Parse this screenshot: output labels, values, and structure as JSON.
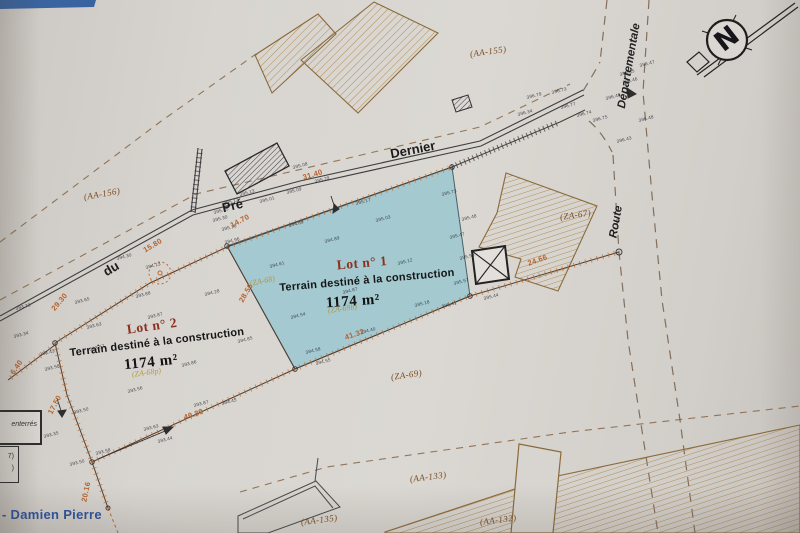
{
  "plan": {
    "compass_label": "N",
    "street": {
      "word1": "du",
      "word2": "Pré",
      "word3": "Dernier"
    },
    "route": {
      "word1": "Route",
      "word2": "Départementale"
    },
    "lot1": {
      "title": "Lot n° 1",
      "subtitle": "Terrain destiné à la construction",
      "area": "1174 m²"
    },
    "lot2": {
      "title": "Lot n° 2",
      "subtitle": "Terrain destiné à la construction",
      "area": "1174 m²"
    },
    "credit": "- Damien Pierre",
    "legend": {
      "box1": "enterrés",
      "box2_line1": "7)",
      "box2_line2": ")"
    },
    "parcel_refs": [
      {
        "v": "(AA-155)",
        "x": 470,
        "y": 50,
        "r": -8
      },
      {
        "v": "(AA-156)",
        "x": 84,
        "y": 193,
        "r": -10
      },
      {
        "v": "(ZA-67)",
        "x": 560,
        "y": 213,
        "r": -8
      },
      {
        "v": "(ZA-69)",
        "x": 391,
        "y": 373,
        "r": -8
      },
      {
        "v": "(AA-133)",
        "x": 410,
        "y": 475,
        "r": -7
      },
      {
        "v": "(AA-135)",
        "x": 301,
        "y": 518,
        "r": -7
      },
      {
        "v": "(AA-132)",
        "x": 480,
        "y": 518,
        "r": -7
      }
    ],
    "old_parcels": [
      {
        "v": "(ZA-68)",
        "x": 250,
        "y": 280,
        "r": -12
      },
      {
        "v": "(ZA-69b)",
        "x": 328,
        "y": 307,
        "r": -8
      },
      {
        "v": "(ZA-68p)",
        "x": 132,
        "y": 371,
        "r": -8
      }
    ],
    "dimensions": [
      {
        "v": "31.40",
        "x": 303,
        "y": 174,
        "r": -17
      },
      {
        "v": "15.80",
        "x": 144,
        "y": 247,
        "r": -31
      },
      {
        "v": "29.30",
        "x": 53,
        "y": 306,
        "r": -50
      },
      {
        "v": "14.70",
        "x": 231,
        "y": 222,
        "r": -28
      },
      {
        "v": "28.56",
        "x": 241,
        "y": 298,
        "r": -60
      },
      {
        "v": "41.32",
        "x": 345,
        "y": 334,
        "r": -19
      },
      {
        "v": "40.39",
        "x": 184,
        "y": 414,
        "r": -19
      },
      {
        "v": "24.66",
        "x": 528,
        "y": 260,
        "r": -20
      },
      {
        "v": "17.50",
        "x": 50,
        "y": 410,
        "r": -62
      },
      {
        "v": "6.40",
        "x": 12,
        "y": 370,
        "r": -55
      },
      {
        "v": "20.16",
        "x": 84,
        "y": 498,
        "r": -78
      }
    ],
    "survey_points": [
      {
        "v": "396.47",
        "x": 640,
        "y": 64
      },
      {
        "v": "396.46",
        "x": 623,
        "y": 81
      },
      {
        "v": "396.40",
        "x": 606,
        "y": 97
      },
      {
        "v": "396.48",
        "x": 639,
        "y": 119
      },
      {
        "v": "396.43",
        "x": 617,
        "y": 140
      },
      {
        "v": "396.45",
        "x": 620,
        "y": 73
      },
      {
        "v": "396.73",
        "x": 552,
        "y": 91
      },
      {
        "v": "396.79",
        "x": 527,
        "y": 96
      },
      {
        "v": "396.34",
        "x": 518,
        "y": 113
      },
      {
        "v": "396.77",
        "x": 561,
        "y": 106
      },
      {
        "v": "396.74",
        "x": 577,
        "y": 114
      },
      {
        "v": "396.75",
        "x": 593,
        "y": 119
      },
      {
        "v": "395.08",
        "x": 293,
        "y": 166
      },
      {
        "v": "395.29",
        "x": 315,
        "y": 180
      },
      {
        "v": "395.09",
        "x": 287,
        "y": 191
      },
      {
        "v": "395.13",
        "x": 240,
        "y": 193
      },
      {
        "v": "395.01",
        "x": 260,
        "y": 200
      },
      {
        "v": "395.12",
        "x": 224,
        "y": 202
      },
      {
        "v": "395.45",
        "x": 214,
        "y": 211
      },
      {
        "v": "395.30",
        "x": 213,
        "y": 219
      },
      {
        "v": "395.10",
        "x": 222,
        "y": 228
      },
      {
        "v": "394.96",
        "x": 225,
        "y": 241
      },
      {
        "v": "394.30",
        "x": 117,
        "y": 257
      },
      {
        "v": "394.13",
        "x": 146,
        "y": 266
      },
      {
        "v": "394.89",
        "x": 289,
        "y": 224
      },
      {
        "v": "395.17",
        "x": 356,
        "y": 202
      },
      {
        "v": "395.03",
        "x": 376,
        "y": 219
      },
      {
        "v": "395.12",
        "x": 398,
        "y": 262
      },
      {
        "v": "394.61",
        "x": 270,
        "y": 265
      },
      {
        "v": "394.89",
        "x": 325,
        "y": 240
      },
      {
        "v": "394.87",
        "x": 343,
        "y": 291
      },
      {
        "v": "394.54",
        "x": 291,
        "y": 316
      },
      {
        "v": "395.18",
        "x": 415,
        "y": 304
      },
      {
        "v": "395.73",
        "x": 442,
        "y": 193
      },
      {
        "v": "395.48",
        "x": 462,
        "y": 218
      },
      {
        "v": "395.47",
        "x": 450,
        "y": 236
      },
      {
        "v": "395.50",
        "x": 460,
        "y": 257
      },
      {
        "v": "395.57",
        "x": 454,
        "y": 282
      },
      {
        "v": "395.44",
        "x": 484,
        "y": 297
      },
      {
        "v": "395.41",
        "x": 442,
        "y": 305
      },
      {
        "v": "394.40",
        "x": 361,
        "y": 331
      },
      {
        "v": "394.58",
        "x": 306,
        "y": 351
      },
      {
        "v": "394.55",
        "x": 316,
        "y": 362
      },
      {
        "v": "393.88",
        "x": 136,
        "y": 295
      },
      {
        "v": "394.28",
        "x": 205,
        "y": 293
      },
      {
        "v": "393.87",
        "x": 148,
        "y": 316
      },
      {
        "v": "393.63",
        "x": 87,
        "y": 326
      },
      {
        "v": "393.57",
        "x": 90,
        "y": 348
      },
      {
        "v": "393.86",
        "x": 182,
        "y": 364
      },
      {
        "v": "394.85",
        "x": 238,
        "y": 340
      },
      {
        "v": "393.56",
        "x": 128,
        "y": 390
      },
      {
        "v": "393.50",
        "x": 74,
        "y": 411
      },
      {
        "v": "393.87",
        "x": 194,
        "y": 404
      },
      {
        "v": "394.45",
        "x": 222,
        "y": 402
      },
      {
        "v": "393.63",
        "x": 144,
        "y": 428
      },
      {
        "v": "393.44",
        "x": 158,
        "y": 440
      },
      {
        "v": "393.35",
        "x": 44,
        "y": 435
      },
      {
        "v": "393.50",
        "x": 70,
        "y": 463
      },
      {
        "v": "393.58",
        "x": 96,
        "y": 452
      },
      {
        "v": "393.73",
        "x": 16,
        "y": 307
      },
      {
        "v": "393.65",
        "x": 75,
        "y": 301
      },
      {
        "v": "393.34",
        "x": 14,
        "y": 335
      },
      {
        "v": "393.43",
        "x": 40,
        "y": 353
      },
      {
        "v": "393.58",
        "x": 45,
        "y": 368
      }
    ]
  },
  "colors": {
    "paper": "#d8d5d0",
    "lot_fill": "#9cc7cf",
    "lot_stroke": "#46606a",
    "dimension": "#b5622d",
    "parcel_ref": "#7a4a1e",
    "old_parcel": "#b3932e",
    "lot_title": "#8d2f1f",
    "credit_blue": "#2b55a0",
    "frame_blue": "#3a64a0"
  }
}
